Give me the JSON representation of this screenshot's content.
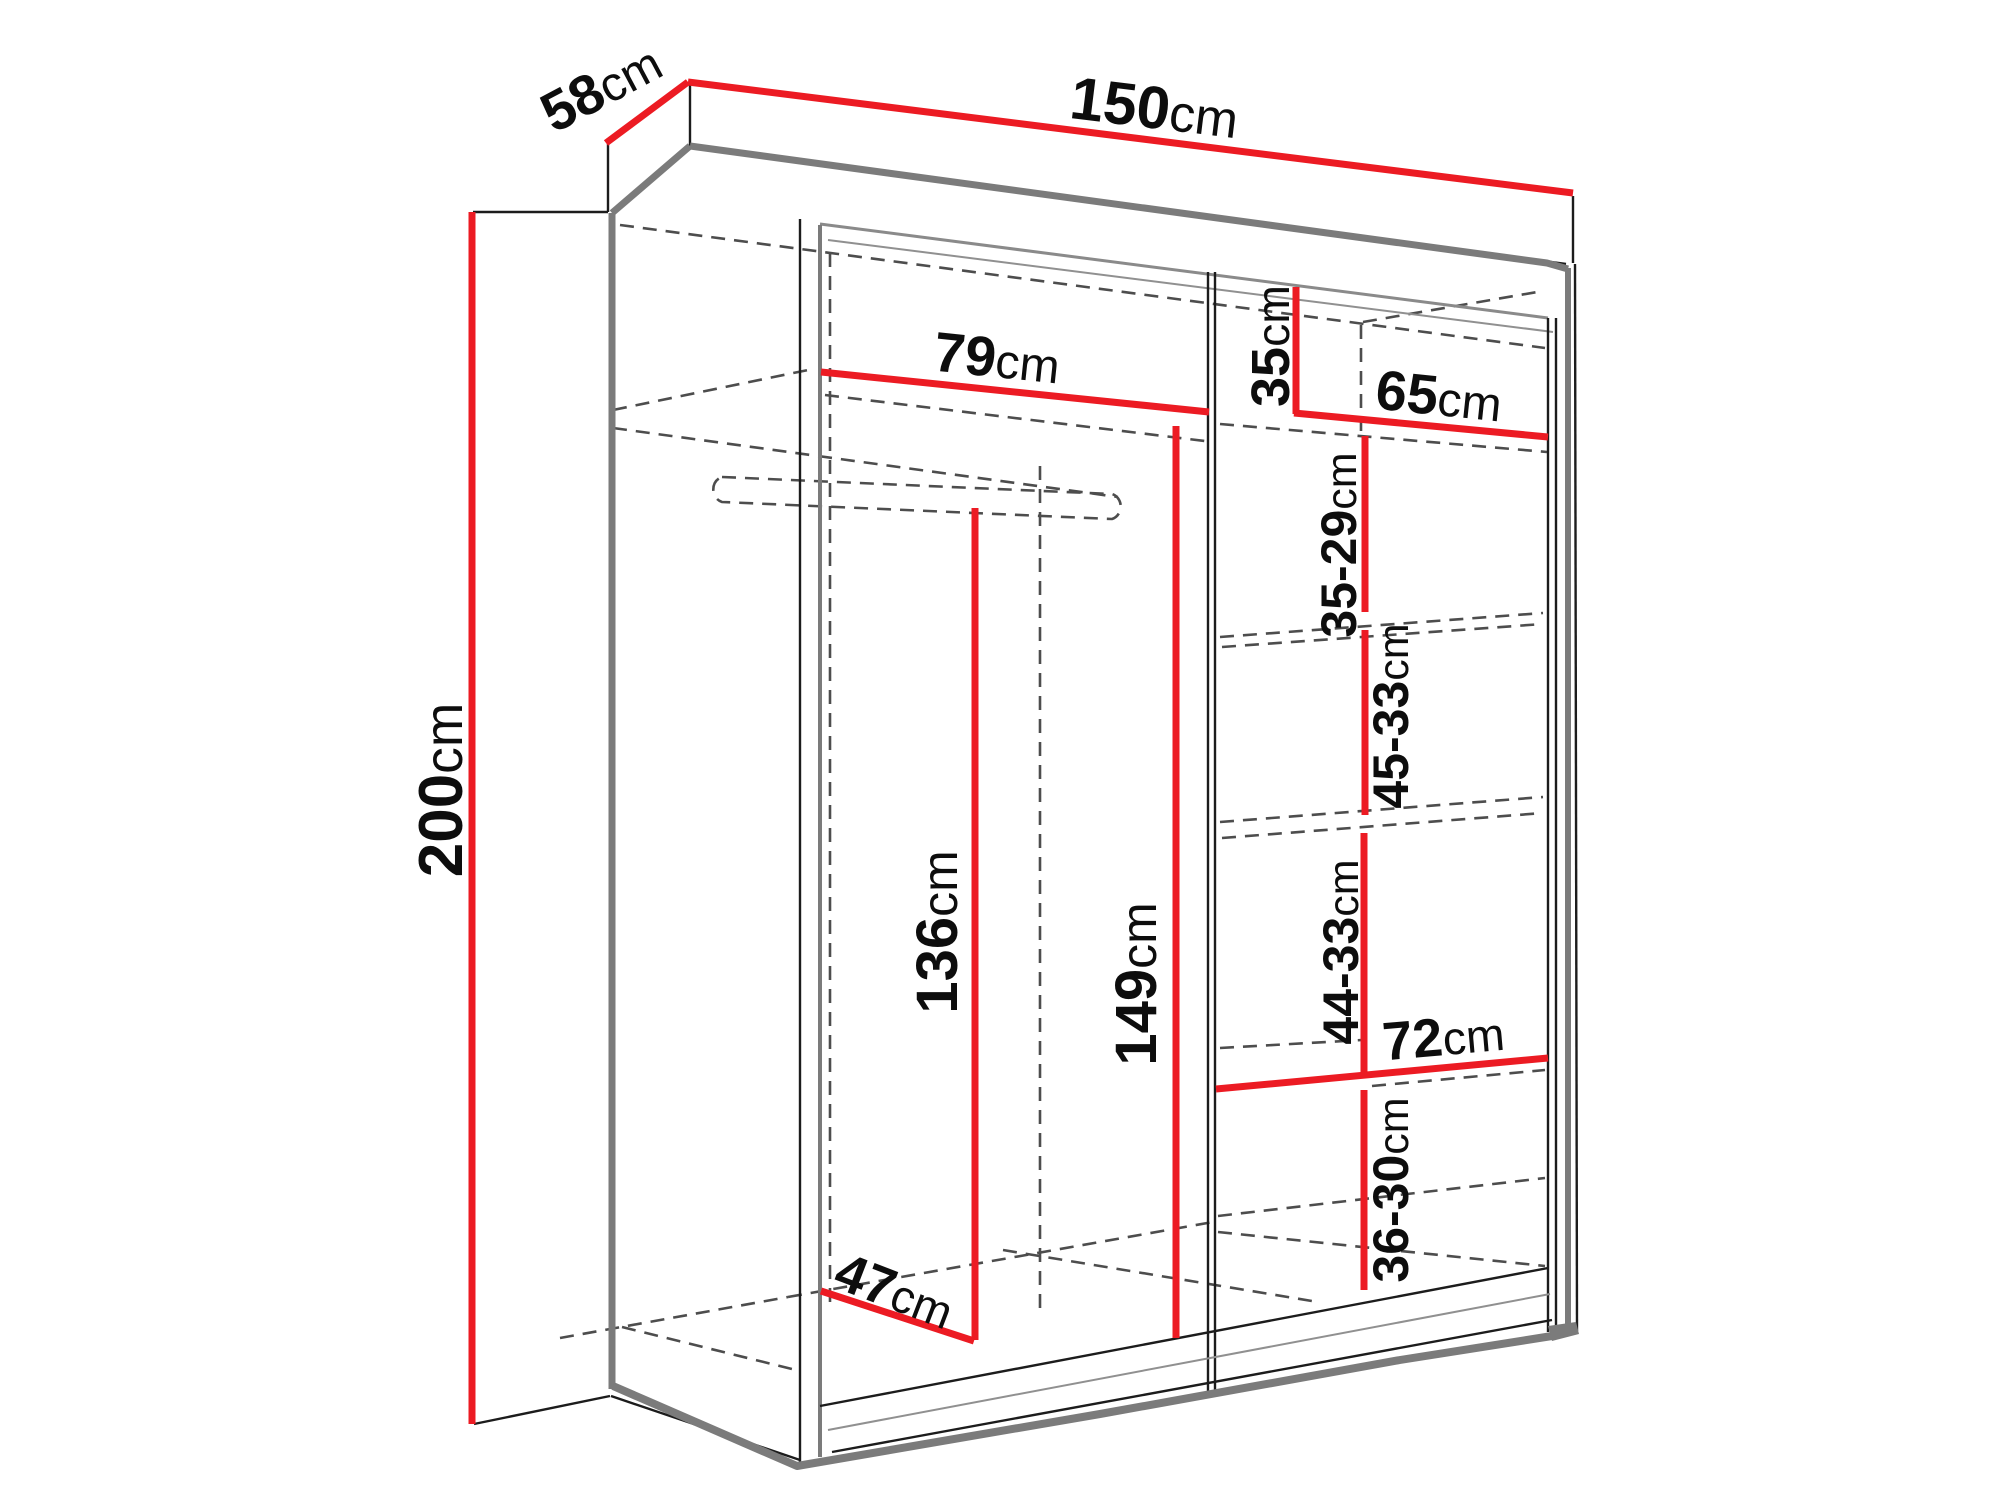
{
  "diagram": {
    "title": "Sliding wardrobe interior dimensions",
    "type": "furniture-dimension-diagram",
    "unit": "cm"
  },
  "colors": {
    "dimension_line": "#ec1b23",
    "outline": "#1c1c1c",
    "panel_gray": "#7b7b7b",
    "hidden_dash": "#4d4d4d",
    "text": "#0d0d0d",
    "background": "#ffffff"
  },
  "dimensions": {
    "depth": {
      "value": "58",
      "unit": "cm"
    },
    "width": {
      "value": "150",
      "unit": "cm"
    },
    "height": {
      "value": "200",
      "unit": "cm"
    },
    "left_shelf_width": {
      "value": "79",
      "unit": "cm"
    },
    "top_right_height": {
      "value": "35",
      "unit": "cm"
    },
    "right_shelf_width": {
      "value": "65",
      "unit": "cm"
    },
    "right_gap_1": {
      "value": "35-29",
      "unit": "cm"
    },
    "right_gap_2": {
      "value": "45-33",
      "unit": "cm"
    },
    "right_gap_3": {
      "value": "44-33",
      "unit": "cm"
    },
    "lower_shelf_width": {
      "value": "72",
      "unit": "cm"
    },
    "right_gap_4": {
      "value": "36-30",
      "unit": "cm"
    },
    "hanging_height": {
      "value": "136",
      "unit": "cm"
    },
    "middle_height": {
      "value": "149",
      "unit": "cm"
    },
    "bottom_depth": {
      "value": "47",
      "unit": "cm"
    }
  }
}
